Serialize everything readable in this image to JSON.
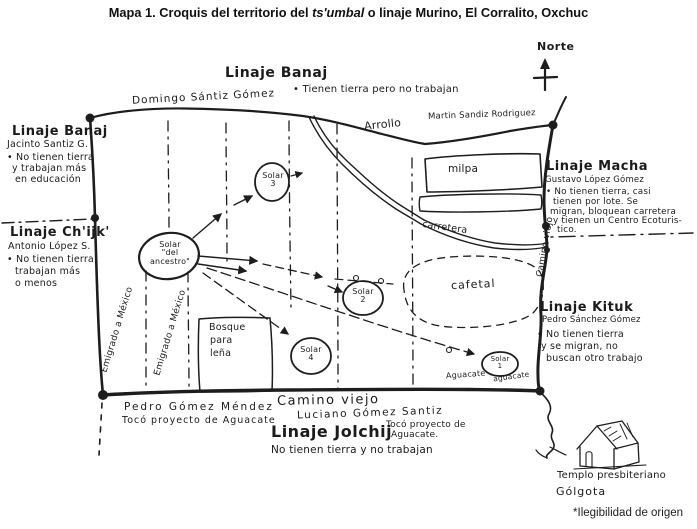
{
  "colors": {
    "ink": "#1d1d1d",
    "paper": "#ffffff"
  },
  "title": {
    "prefix": "Mapa 1. Croquis del territorio del ",
    "emphasis": "ts'umbal",
    "suffix": " o linaje Murino, El Corralito, Oxchuc"
  },
  "compass": {
    "label": "Norte"
  },
  "footnote": "*Ilegibilidad de origen",
  "blocks": {
    "banaj_left": {
      "title": "Linaje Banaj",
      "person": "Jacinto Santiz G.",
      "line1": "• No tienen tierra",
      "line2": "y trabajan más",
      "line3": "en educación"
    },
    "banaj_top": {
      "title": "Linaje Banaj",
      "owner": "Domingo Sántiz Gómez",
      "note": "• Tienen tierra pero no trabajan"
    },
    "chijk": {
      "title": "Linaje Ch'ijk'",
      "person": "Antonio López S.",
      "line1": "• No tienen tierra",
      "line2": "trabajan más",
      "line3": "o menos"
    },
    "macha": {
      "title": "Linaje Macha",
      "person": "Gustavo López Gómez",
      "line1": "• No tienen tierra, casi",
      "line2": "tienen por lote. Se",
      "line3": "migran, bloquean carretera",
      "line4": "y tienen un Centro Ecoturis-",
      "line5": "tico."
    },
    "kituk": {
      "title": "Linaje Kituk",
      "person": "Pedro Sánchez Gómez",
      "line1": "• No tienen tierra",
      "line2": "y se migran, no",
      "line3": "buscan otro trabajo"
    },
    "jolchij": {
      "title": "Linaje Jolchij",
      "note": "No tienen tierra y no trabajan",
      "person1": "Pedro Gómez Méndez",
      "person1_note": "Tocó proyecto de Aguacate",
      "person2": "Luciano Gómez Santiz",
      "person2_note_line1": "Tocó proyecto de",
      "person2_note_line2": "Aguacate."
    },
    "martin": "Martin Sandiz Rodriguez"
  },
  "features": {
    "arroyo": "Arrollo",
    "milpa": "milpa",
    "carretera": "carretera",
    "cafetal": "cafetal",
    "bosque_line1": "Bosque",
    "bosque_line2": "para",
    "bosque_line3": "leña",
    "camino_viejo_bottom": "Camino viejo",
    "camino_viejo_right": "Camino viejo",
    "emigrado_1": "Emigrado a México",
    "emigrado_2": "Emigrado a México",
    "aguacate_1": "Aguacate",
    "aguacate_2": "aguacate",
    "templo_line1": "Templo presbiteriano",
    "templo_line2": "Gólgota"
  },
  "solares": {
    "ancestro_line1": "Solar",
    "ancestro_line2": "\"del",
    "ancestro_line3": "ancestro\"",
    "s1_line1": "Solar",
    "s1_line2": "1",
    "s2_line1": "Solar",
    "s2_line2": "2",
    "s3_line1": "Solar",
    "s3_line2": "3",
    "s4_line1": "Solar",
    "s4_line2": "4"
  }
}
